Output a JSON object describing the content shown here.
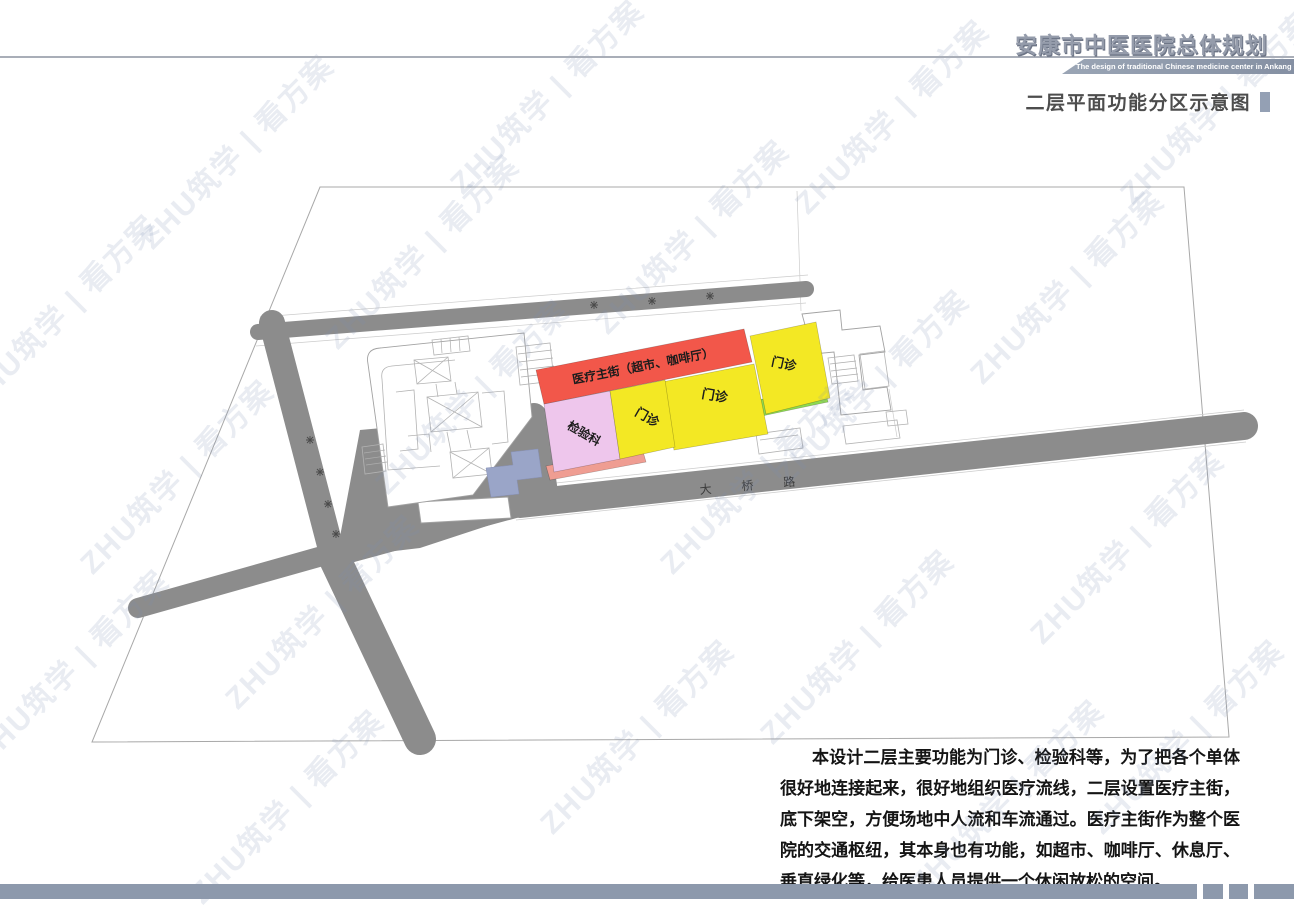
{
  "header": {
    "title": "安康市中医医院总体规划",
    "subtitle_en": "The design of traditional Chinese medicine center in Ankang City"
  },
  "section": {
    "title": "二层平面功能分区示意图"
  },
  "plan": {
    "road_label": "大桥路",
    "zones": [
      {
        "id": "medical-street",
        "label": "医疗主街（超市、咖啡厅）",
        "color": "#f2574a"
      },
      {
        "id": "laboratory",
        "label": "检验科",
        "color": "#eec6ec"
      },
      {
        "id": "outpatient-west",
        "label": "门诊",
        "color": "#f3e824"
      },
      {
        "id": "outpatient-center",
        "label": "门诊",
        "color": "#f3e824"
      },
      {
        "id": "outpatient-east",
        "label": "门诊",
        "color": "#f3e824"
      },
      {
        "id": "green-link",
        "label": "",
        "color": "#8ed94f"
      },
      {
        "id": "base-strip",
        "label": "",
        "color": "#ef9d92"
      }
    ]
  },
  "description": {
    "text": "本设计二层主要功能为门诊、检验科等，为了把各个单体很好地连接起来，很好地组织医疗流线，二层设置医疗主街，底下架空，方便场地中人流和车流通过。医疗主街作为整个医院的交通枢纽，其本身也有功能，如超市、咖啡厅、休息厅、垂直绿化等，给医患人员提供一个休闲放松的空间。"
  },
  "watermark": {
    "text": "ZHU筑学 | 看方案",
    "tiles": [
      [
        60,
        310
      ],
      [
        235,
        150
      ],
      [
        175,
        475
      ],
      [
        70,
        665
      ],
      [
        320,
        610
      ],
      [
        285,
        805
      ],
      [
        470,
        395
      ],
      [
        545,
        95
      ],
      [
        690,
        235
      ],
      [
        635,
        735
      ],
      [
        755,
        475
      ],
      [
        890,
        115
      ],
      [
        870,
        385
      ],
      [
        855,
        645
      ],
      [
        1065,
        285
      ],
      [
        1125,
        545
      ],
      [
        1005,
        795
      ],
      [
        1215,
        105
      ],
      [
        1185,
        735
      ],
      [
        420,
        250
      ]
    ]
  },
  "colors": {
    "accent_bar": "#8d99ac",
    "divider_line": "#a9aeb8",
    "road": "#8c8c8c",
    "title_gray": "#959cab",
    "section_marker": "#94a0b4"
  }
}
